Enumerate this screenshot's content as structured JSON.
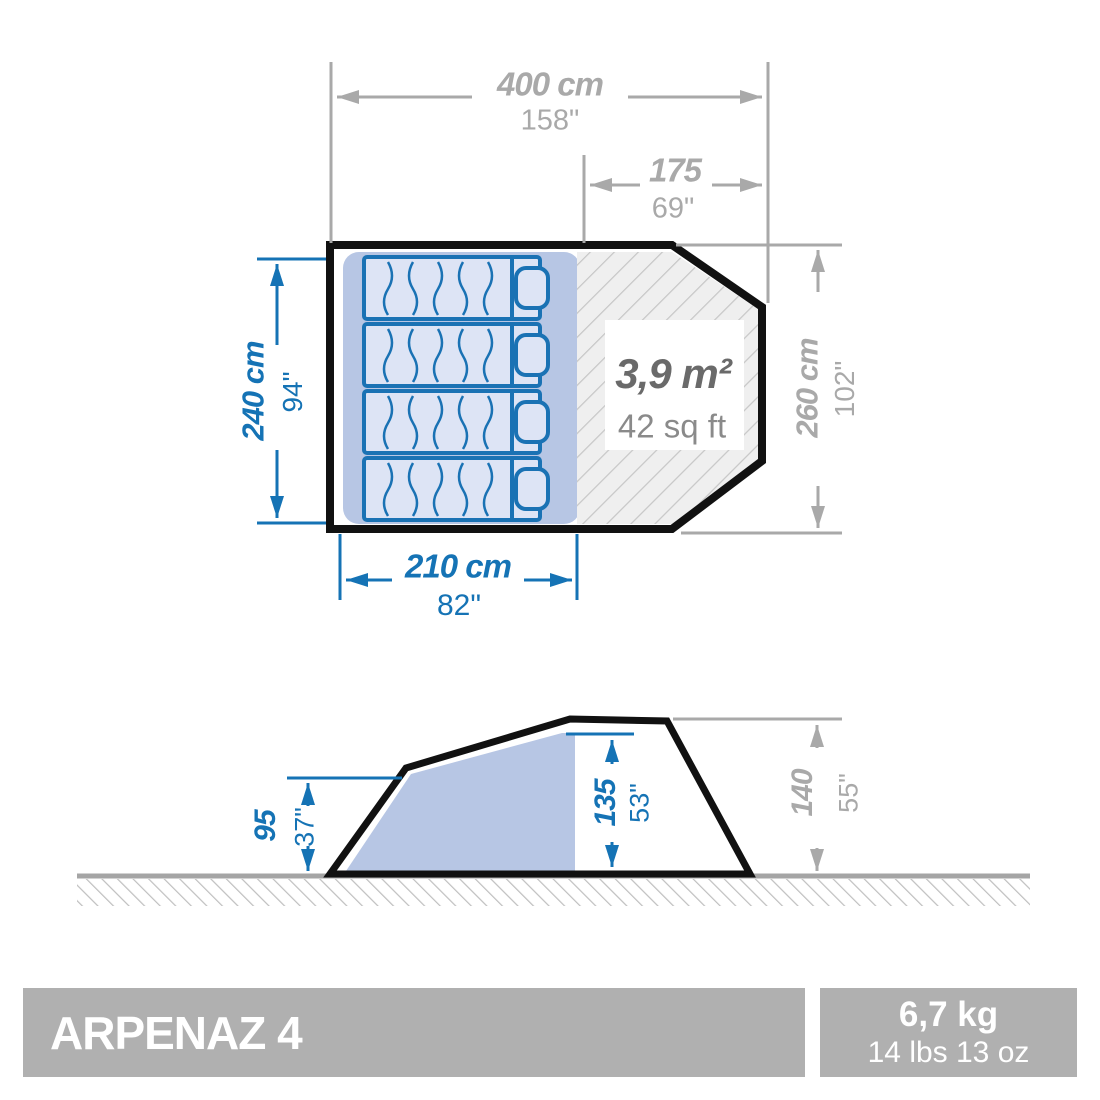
{
  "colors": {
    "accent_blue": "#1573b5",
    "dim_gray": "#a9a9a9",
    "tent_outline": "#111111",
    "inner_fill": "#b7c6e4",
    "mat_fill": "#dde4f5",
    "area_text": "#6a6a6a",
    "area_subtext": "#8a8a8a",
    "footer_bg": "#b0b0b0"
  },
  "top_view": {
    "total_width": {
      "cm": "400 cm",
      "inch": "158\""
    },
    "living_room_width": {
      "cm": "175",
      "inch": "69\""
    },
    "bedroom_depth": {
      "cm": "240 cm",
      "inch": "94\""
    },
    "total_depth": {
      "cm": "260 cm",
      "inch": "102\""
    },
    "bedroom_width": {
      "cm": "210 cm",
      "inch": "82\""
    },
    "living_area": {
      "metric": "3,9 m²",
      "imperial": "42 sq ft"
    }
  },
  "side_view": {
    "door_height": {
      "cm": "95",
      "inch": "37\""
    },
    "interior_height": {
      "cm": "135",
      "inch": "53\""
    },
    "peak_height": {
      "cm": "140",
      "inch": "55\""
    }
  },
  "footer": {
    "model_name": "ARPENAZ 4",
    "weight_metric": "6,7 kg",
    "weight_imperial": "14 lbs 13 oz"
  }
}
